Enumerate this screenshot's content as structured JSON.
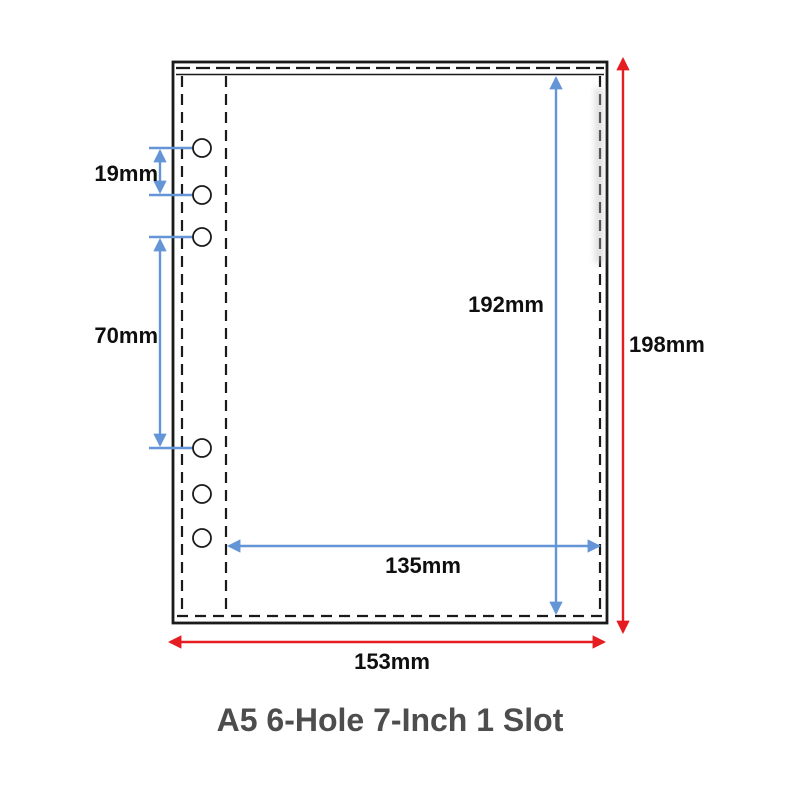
{
  "title": "A5 6-Hole 7-Inch 1 Slot",
  "colors": {
    "blue_dimension": "#6495d6",
    "red_dimension": "#e51c20",
    "outline": "#1a1a1a",
    "label_text": "#0f0f0f",
    "title_text": "#4d4d4d",
    "background": "#ffffff"
  },
  "diagram": {
    "type": "product-dimension-diagram",
    "subject": "A5 6-ring binder pocket sleeve, 1 slot",
    "hole_count": 6,
    "measurements": {
      "hole_spacing_small": "19mm",
      "hole_spacing_large": "70mm",
      "slot_inner_height": "192mm",
      "slot_inner_width": "135mm",
      "outer_height": "198mm",
      "outer_width": "153mm"
    }
  }
}
